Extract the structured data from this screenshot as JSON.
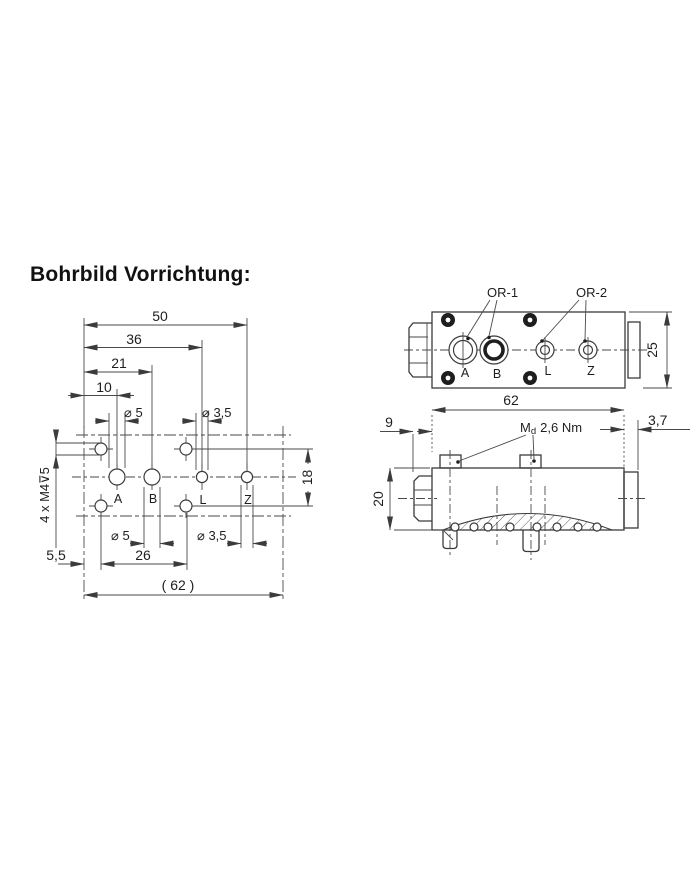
{
  "title": "Bohrbild Vorrichtung:",
  "colors": {
    "line": "#3b3b3b",
    "text": "#1e1e1e",
    "background": "#ffffff"
  },
  "drilling_pattern_view": {
    "dims": {
      "width_50": "50",
      "width_36": "36",
      "width_21": "21",
      "width_10": "10",
      "dia_5_top": "⌀ 5",
      "dia_3_5_top": "⌀ 3,5",
      "height_18": "18",
      "thread_note": "4 x M4⊽5",
      "dia_5_bottom": "⌀ 5",
      "spacing_26": "26",
      "dia_3_5_bottom": "⌀ 3,5",
      "offset_5_5": "5,5",
      "overall_62": "( 62 )"
    },
    "port_labels": {
      "a": "A",
      "b": "B",
      "l": "L",
      "z": "Z"
    }
  },
  "block_top_view": {
    "oring_1": "OR-1",
    "oring_2": "OR-2",
    "height_25": "25",
    "port_labels": {
      "a": "A",
      "b": "B",
      "l": "L",
      "z": "Z"
    }
  },
  "block_side_view": {
    "length_62": "62",
    "hex_9": "9",
    "torque_m": "M",
    "torque_sub": "d",
    "torque_value": "2,6 Nm",
    "tab_3_7": "3,7",
    "height_20": "20"
  }
}
